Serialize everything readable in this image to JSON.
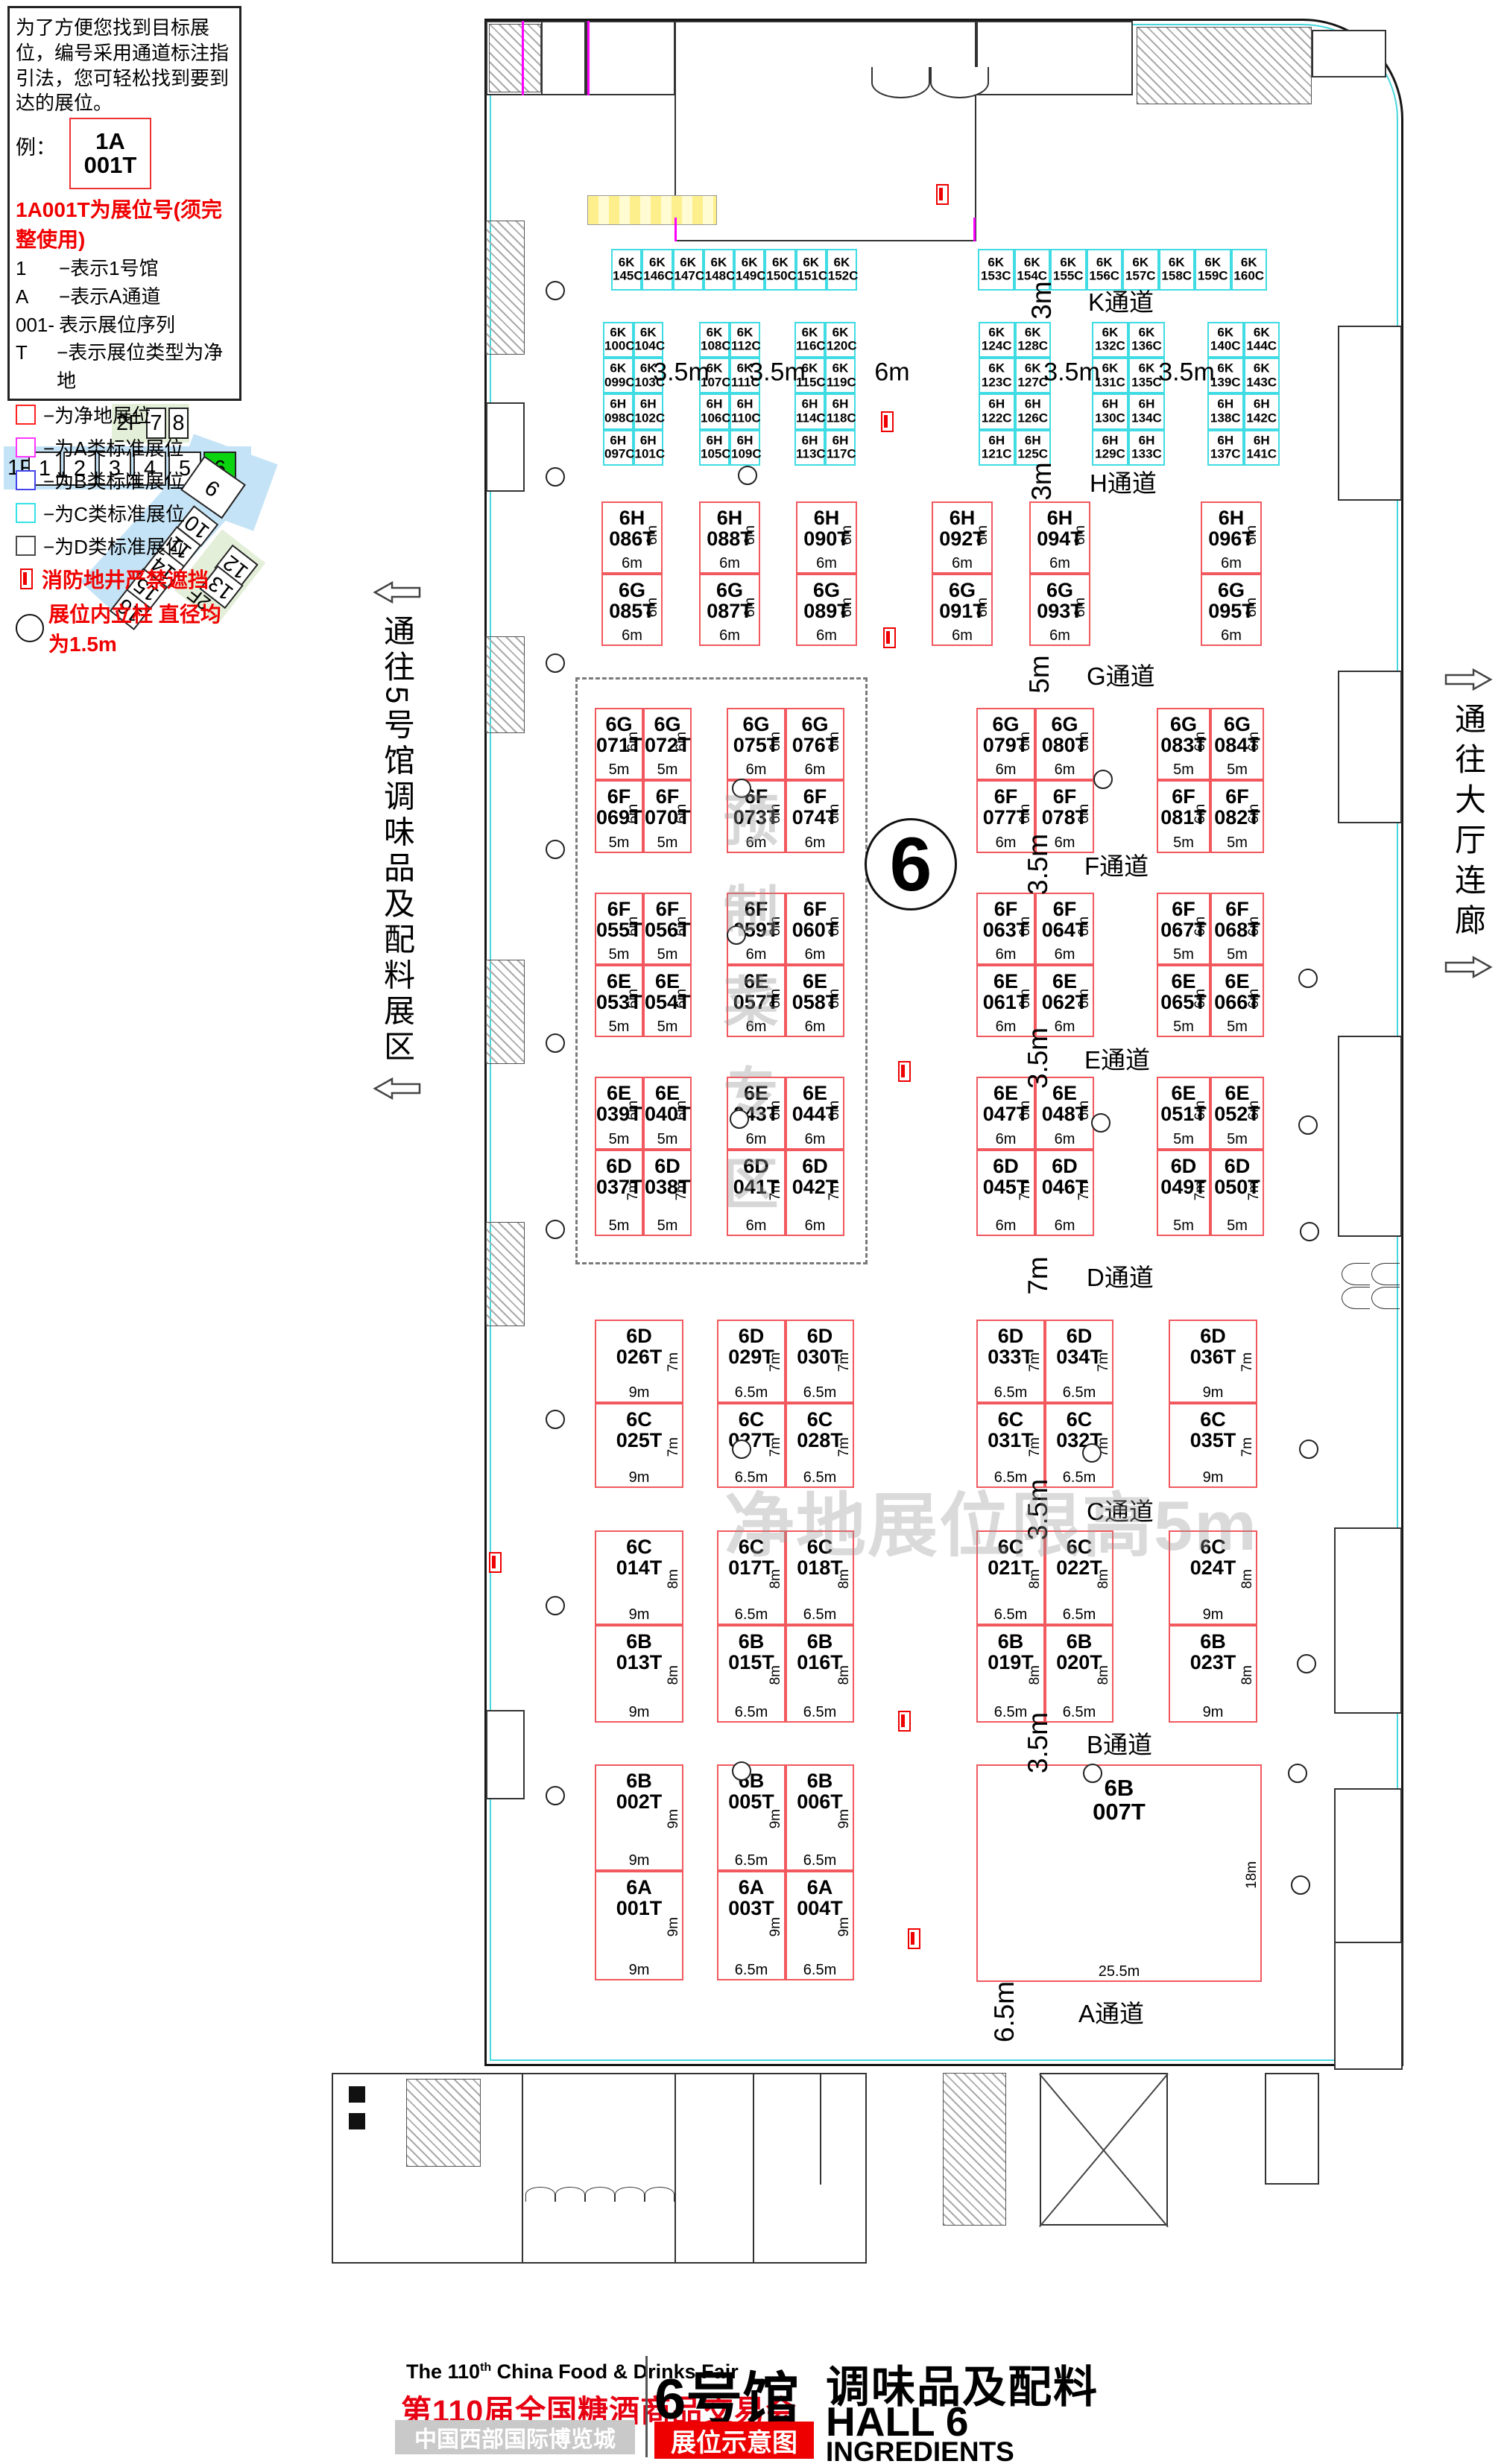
{
  "legend": {
    "intro": "为了方便您找到目标展位，编号采用通道标注指引法，您可轻松找到要到达的展位。",
    "example_prefix": "例：",
    "example_top": "1A",
    "example_bottom": "001T",
    "headline": "1A001T为展位号(须完整使用)",
    "rules": [
      {
        "k": "1",
        "v": "−表示1号馆"
      },
      {
        "k": "A",
        "v": "−表示A通道"
      },
      {
        "k": "001-",
        "v": "表示展位序列"
      },
      {
        "k": "T",
        "v": "−表示展位类型为净地"
      }
    ],
    "types": [
      {
        "color": "#ff2222",
        "label": "−为净地展位"
      },
      {
        "color": "#ff35ff",
        "label": "−为A类标准展位"
      },
      {
        "color": "#4444ee",
        "label": "−为B类标准展位"
      },
      {
        "color": "#35e2e8",
        "label": "−为C类标准展位"
      },
      {
        "color": "#4a4a4a",
        "label": "−为D类标准展位"
      }
    ],
    "fire_note": "消防地井严禁遮挡",
    "pillar_note": "展位内立柱 直径均为1.5m"
  },
  "minimap": {
    "f2": {
      "label": "2F",
      "halls": [
        "7",
        "8"
      ]
    },
    "f1": {
      "label": "1F",
      "halls": [
        "1",
        "2",
        "3",
        "4",
        "5",
        "6"
      ],
      "active": "6"
    },
    "diag_hall": "9",
    "diag": [
      "10",
      "11",
      "14",
      "15",
      "16"
    ],
    "f2b": {
      "label": "2F",
      "halls": [
        "12",
        "13"
      ]
    }
  },
  "side": {
    "left": "通往5号馆调味品及配料展区",
    "right": "通往大厅连廊"
  },
  "watermarks": {
    "zone": "预制菜专区",
    "limit": "净地展位限高5m"
  },
  "hall_circle": "6",
  "aisles": [
    {
      "n": "K通道",
      "w": "3m"
    },
    {
      "n": "H通道",
      "w": "3m"
    },
    {
      "n": "G通道",
      "w": "5m"
    },
    {
      "n": "F通道",
      "w": "3.5m"
    },
    {
      "n": "E通道",
      "w": "3.5m"
    },
    {
      "n": "D通道",
      "w": "7m"
    },
    {
      "n": "C通道",
      "w": "3.5m"
    },
    {
      "n": "B通道",
      "w": "3.5m"
    },
    {
      "n": "A通道",
      "w": "6.5m"
    }
  ],
  "k_gaps": [
    "3.5m",
    "3.5m",
    "6m",
    "3.5m",
    "3.5m"
  ],
  "k_top": [
    [
      "6K 145C",
      "6K 146C",
      "6K 147C",
      "6K 148C",
      "6K 149C",
      "6K 150C",
      "6K 151C",
      "6K 152C"
    ],
    [
      "6K 153C",
      "6K 154C",
      "6K 155C",
      "6K 156C",
      "6K 157C",
      "6K 158C",
      "6K 159C",
      "6K 160C"
    ]
  ],
  "k_blocks": [
    [
      [
        "6K 100C",
        "6K 104C"
      ],
      [
        "6K 099C",
        "6K 103C"
      ],
      [
        "6H 098C",
        "6H 102C"
      ],
      [
        "6H 097C",
        "6H 101C"
      ]
    ],
    [
      [
        "6K 108C",
        "6K 112C"
      ],
      [
        "6K 107C",
        "6K 111C"
      ],
      [
        "6H 106C",
        "6H 110C"
      ],
      [
        "6H 105C",
        "6H 109C"
      ]
    ],
    [
      [
        "6K 116C",
        "6K 120C"
      ],
      [
        "6K 115C",
        "6K 119C"
      ],
      [
        "6H 114C",
        "6H 118C"
      ],
      [
        "6H 113C",
        "6H 117C"
      ]
    ],
    [
      [
        "6K 124C",
        "6K 128C"
      ],
      [
        "6K 123C",
        "6K 127C"
      ],
      [
        "6H 122C",
        "6H 126C"
      ],
      [
        "6H 121C",
        "6H 125C"
      ]
    ],
    [
      [
        "6K 132C",
        "6K 136C"
      ],
      [
        "6K 131C",
        "6K 135C"
      ],
      [
        "6H 130C",
        "6H 134C"
      ],
      [
        "6H 129C",
        "6H 133C"
      ]
    ],
    [
      [
        "6K 140C",
        "6K 144C"
      ],
      [
        "6K 139C",
        "6K 143C"
      ],
      [
        "6H 138C",
        "6H 142C"
      ],
      [
        "6H 137C",
        "6H 141C"
      ]
    ]
  ],
  "hg_pairs": [
    [
      "6H 086T",
      "6G 085T"
    ],
    [
      "6H 088T",
      "6G 087T"
    ],
    [
      "6H 090T",
      "6G 089T"
    ],
    [
      "6H 092T",
      "6G 091T"
    ],
    [
      "6H 094T",
      "6G 093T"
    ],
    [
      "6H 096T",
      "6G 095T"
    ]
  ],
  "hg_dims": {
    "w": "6m",
    "h": "6m"
  },
  "blocks_gf": [
    {
      "top": [
        "6G 071T",
        "6G 072T"
      ],
      "bot": [
        "6F 069T",
        "6F 070T"
      ],
      "w": "5m"
    },
    {
      "top": [
        "6G 075T",
        "6G 076T"
      ],
      "bot": [
        "6F 073T",
        "6F 074T"
      ],
      "w": "6m"
    },
    {
      "top": [
        "6G 079T",
        "6G 080T"
      ],
      "bot": [
        "6F 077T",
        "6F 078T"
      ],
      "w": "6m"
    },
    {
      "top": [
        "6G 083T",
        "6G 084T"
      ],
      "bot": [
        "6F 081T",
        "6F 082T"
      ],
      "w": "5m"
    }
  ],
  "blocks_fe": [
    {
      "top": [
        "6F 055T",
        "6F 056T"
      ],
      "bot": [
        "6E 053T",
        "6E 054T"
      ],
      "w": "5m"
    },
    {
      "top": [
        "6F 059T",
        "6F 060T"
      ],
      "bot": [
        "6E 057T",
        "6E 058T"
      ],
      "w": "6m"
    },
    {
      "top": [
        "6F 063T",
        "6F 064T"
      ],
      "bot": [
        "6E 061T",
        "6E 062T"
      ],
      "w": "6m"
    },
    {
      "top": [
        "6F 067T",
        "6F 068T"
      ],
      "bot": [
        "6E 065T",
        "6E 066T"
      ],
      "w": "5m"
    }
  ],
  "blocks_ed": [
    {
      "top": [
        "6E 039T",
        "6E 040T"
      ],
      "bot": [
        "6D 037T",
        "6D 038T"
      ],
      "w": "5m"
    },
    {
      "top": [
        "6E 043T",
        "6E 044T"
      ],
      "bot": [
        "6D 041T",
        "6D 042T"
      ],
      "w": "6m"
    },
    {
      "top": [
        "6E 047T",
        "6E 048T"
      ],
      "bot": [
        "6D 045T",
        "6D 046T"
      ],
      "w": "6m"
    },
    {
      "top": [
        "6E 051T",
        "6E 052T"
      ],
      "bot": [
        "6D 049T",
        "6D 050T"
      ],
      "w": "5m"
    }
  ],
  "row_dc": [
    {
      "top": [
        "6D 026T"
      ],
      "bot": [
        "6C 025T"
      ],
      "w": "9m"
    },
    {
      "top": [
        "6D 029T",
        "6D 030T"
      ],
      "bot": [
        "6C 027T",
        "6C 028T"
      ],
      "w": "6.5m"
    },
    {
      "top": [
        "6D 033T",
        "6D 034T"
      ],
      "bot": [
        "6C 031T",
        "6C 032T"
      ],
      "w": "6.5m"
    },
    {
      "top": [
        "6D 036T"
      ],
      "bot": [
        "6C 035T"
      ],
      "w": "9m"
    }
  ],
  "row_cb": [
    {
      "top": [
        "6C 014T"
      ],
      "bot": [
        "6B 013T"
      ],
      "w": "9m"
    },
    {
      "top": [
        "6C 017T",
        "6C 018T"
      ],
      "bot": [
        "6B 015T",
        "6B 016T"
      ],
      "w": "6.5m"
    },
    {
      "top": [
        "6C 021T",
        "6C 022T"
      ],
      "bot": [
        "6B 019T",
        "6B 020T"
      ],
      "w": "6.5m"
    },
    {
      "top": [
        "6C 024T"
      ],
      "bot": [
        "6B 023T"
      ],
      "w": "9m"
    }
  ],
  "row_ba": [
    {
      "top": [
        "6B 002T"
      ],
      "bot": [
        "6A 001T"
      ],
      "w": "9m"
    },
    {
      "top": [
        "6B 005T",
        "6B 006T"
      ],
      "bot": [
        "6A 003T",
        "6A 004T"
      ],
      "w": "6.5m"
    }
  ],
  "section_heights": {
    "gf": "6m",
    "fe": "6m",
    "ed_top": "6m",
    "ed_bot": "7m",
    "dc": "7m",
    "cb": "8m",
    "ba": "9m"
  },
  "big_booth": {
    "code": "6B 007T",
    "w": "25.5m",
    "h": "18m"
  },
  "footer": {
    "en_pre": "The 110",
    "en_sup": "th",
    "en_post": " China Food & Drinks Fair",
    "cn": "第110届全国糖酒商品交易会",
    "venue": "中国西部国际博览城",
    "hall_cn": "6号馆",
    "category": "调味品及配料",
    "hall_en": "HALL 6",
    "hall_en_sub": "INGREDIENTS",
    "badge": "展位示意图"
  },
  "colors": {
    "net_booth": "#f2595f",
    "c_type_booth": "#3fdce3",
    "highlight_green": "#0ad410",
    "accent_red": "#ee0000"
  }
}
